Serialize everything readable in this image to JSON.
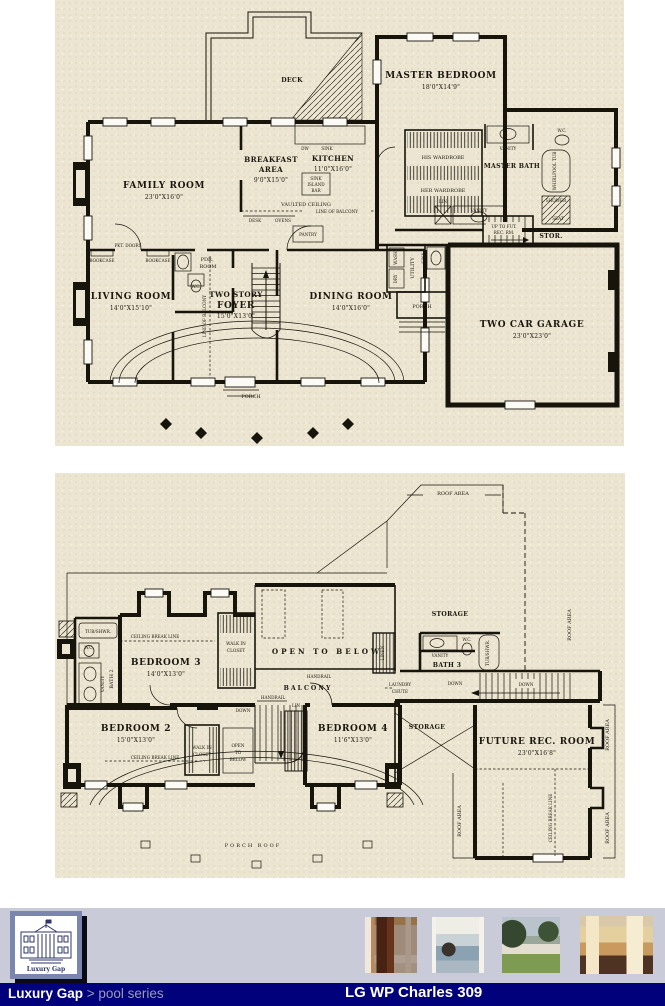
{
  "floor1": {
    "deck": "DECK",
    "family_room": "FAMILY ROOM",
    "family_room_dim": "23'0\"X16'0\"",
    "breakfast_1": "BREAKFAST",
    "breakfast_2": "AREA",
    "breakfast_dim": "9'0\"X15'0\"",
    "kitchen": "KITCHEN",
    "kitchen_dim": "11'0\"X16'0\"",
    "vaulted_ceiling": "VAULTED CEILING",
    "line_of_balcony": "LINE OF BALCONY",
    "dw": "DW",
    "sink": "SINK",
    "island": "ISLAND",
    "bar": "BAR",
    "desk": "DESK",
    "ovens": "OVENS",
    "pantry": "PANTRY",
    "master_bedroom": "MASTER BEDROOM",
    "master_bedroom_dim": "18'0\"X14'9\"",
    "his_wardrobe": "HIS WARDROBE",
    "her_wardrobe": "HER WARDROBE",
    "master_bath": "MASTER BATH",
    "vanity": "VANITY",
    "wc": "W.C.",
    "whirlpool_tub": "WHIRLPOOL TUB",
    "shower": "SHOWER",
    "seat": "SEAT",
    "lin": "LIN",
    "up_stairs_1": "UP TO FUT.",
    "up_stairs_2": "REC. RM.",
    "stor": "STOR.",
    "living_room": "LIVING ROOM",
    "living_room_dim": "14'0\"X15'10\"",
    "pdr_1": "PDR.",
    "pdr_2": "ROOM",
    "two_story": "TWO STORY",
    "foyer": "FOYER",
    "foyer_dim": "15'0\"X13'0\"",
    "dining_room": "DINING ROOM",
    "dining_room_dim": "14'0\"X16'0\"",
    "bookcase": "BOOKCASE",
    "pkt_doors": "PKT. DOORS",
    "utility": "UTILITY",
    "wash": "WASH",
    "dry": "DRY",
    "porch": "PORCH",
    "garage": "TWO CAR GARAGE",
    "garage_dim": "23'0\"X23'0\""
  },
  "floor2": {
    "roof_area": "ROOF AREA",
    "storage": "STORAGE",
    "bath2": "BATH 2",
    "bath3": "BATH 3",
    "vanity": "VANITY",
    "wc": "W.C.",
    "tub_shwr": "TUB/SHWR.",
    "bedroom2": "BEDROOM 2",
    "bedroom2_dim": "15'0\"X13'0\"",
    "bedroom3": "BEDROOM 3",
    "bedroom3_dim": "14'0\"X13'0\"",
    "bedroom4": "BEDROOM 4",
    "bedroom4_dim": "11'6\"X13'0\"",
    "walk_in": "WALK IN",
    "closet": "CLOSET",
    "open_to_below": "OPEN TO BELOW",
    "open": "OPEN",
    "to": "TO",
    "below": "BELOW",
    "handrail": "HANDRAIL",
    "balcony": "BALCONY",
    "linen": "LINEN",
    "lin": "LIN",
    "laundry": "LAUNDRY",
    "chute": "CHUTE",
    "down": "DOWN",
    "ceiling_break_line": "CEILING BREAK LINE",
    "future_rec_room": "FUTURE REC. ROOM",
    "future_rec_dim": "23'0\"X16'8\"",
    "porch_roof": "PORCH ROOF"
  },
  "footer": {
    "logo_caption": "Luxury Gap",
    "breadcrumb_brand": "Luxury Gap",
    "breadcrumb_path": " > pool series",
    "plan_title": "LG WP Charles 309"
  }
}
